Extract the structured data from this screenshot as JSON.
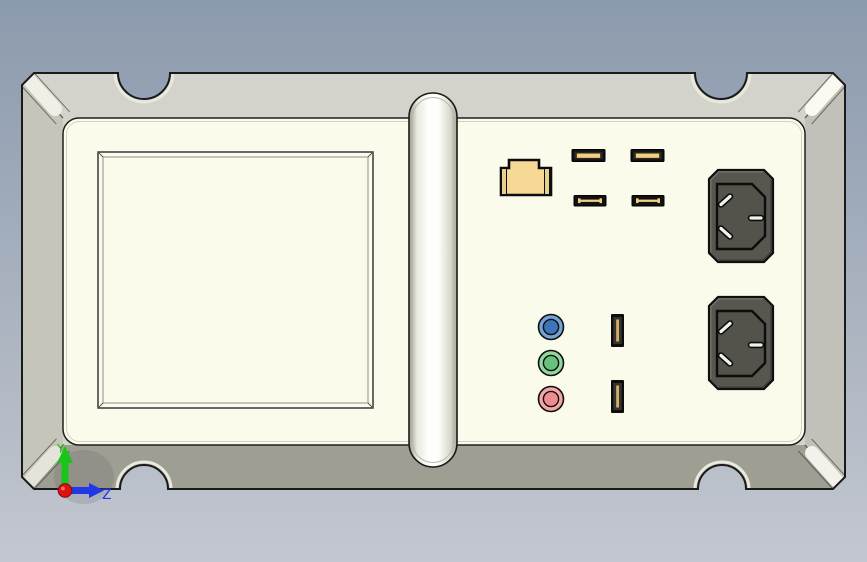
{
  "viewport": {
    "type": "3d-cad-view",
    "background_top": "#8b9aad",
    "background_bottom": "#c3c7cf"
  },
  "model": {
    "name": "instrument-panel-rear-view",
    "face_color": "#fbfbec",
    "top_face_color": "#d3d3cb",
    "bottom_face_color": "#9e9e92",
    "left_face_color": "#c5c5b9",
    "right_face_color": "#c1c1b9",
    "outline_color": "#1a1a1a",
    "handle_color": "#ffffff",
    "ports": {
      "ethernet": {
        "label": "rj45-ethernet",
        "color": "#f6d995",
        "ear_color": "#e7d08e"
      },
      "usb_horizontal": {
        "count": 4,
        "slot_color": "#111111",
        "tongue_color": "#f2d083"
      },
      "usb_vertical": {
        "count": 2,
        "slot_color": "#0d0d0d",
        "tongue_color": "#d8ae66"
      },
      "audio_jacks": [
        {
          "label": "line-in",
          "ring_color": "#72a2d6",
          "center_color": "#3f74b8"
        },
        {
          "label": "line-out",
          "ring_color": "#90d8a0",
          "center_color": "#68c27e"
        },
        {
          "label": "microphone",
          "ring_color": "#f4a6a6",
          "center_color": "#ee8d90"
        }
      ],
      "power_inlets": {
        "count": 2,
        "body_color": "#57574f",
        "recess_color": "#53534b",
        "pin_color": "#f2f2ea"
      }
    }
  },
  "axis_triad": {
    "y_label": "Y",
    "z_label": "Z",
    "y_color": "#18c518",
    "z_color": "#2038e8",
    "origin_color": "#e01010"
  }
}
